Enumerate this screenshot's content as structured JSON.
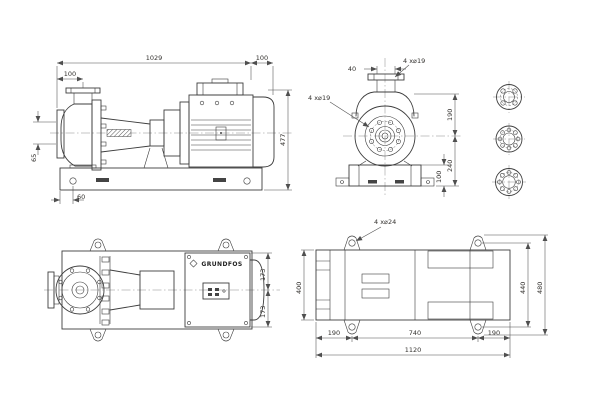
{
  "drawing": {
    "side": {
      "overall_length": "1029",
      "fan_end": "100",
      "suction_offset": "100",
      "suction_bore": "65",
      "total_height": "477",
      "foot_edge": "60"
    },
    "end": {
      "discharge_bore": "40",
      "discharge_flange_holes": "4 x⌀19",
      "suction_flange_holes": "4 x⌀19",
      "flange_to_centerline": "190",
      "centerline_to_base": "240",
      "base_height": "100"
    },
    "plan": {
      "brand": "GRUNDFOS",
      "half_width_upper": "173",
      "half_width_lower": "173"
    },
    "base": {
      "anchor_holes": "4 x⌀24",
      "edge_to_hole_left": "190",
      "hole_spacing": "740",
      "edge_to_hole_right": "190",
      "overall_length": "1120",
      "plate_width": "400",
      "hole_span_width": "440",
      "overall_width": "480"
    }
  }
}
